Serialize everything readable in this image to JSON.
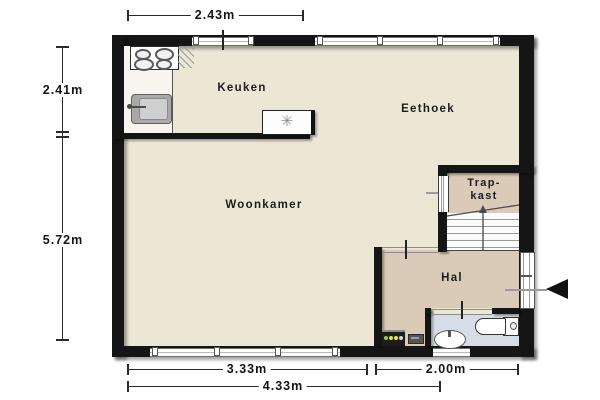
{
  "plan": {
    "rooms": {
      "keuken": "Keuken",
      "eethoek": "Eethoek",
      "woonkamer": "Woonkamer",
      "trapkast_line1": "Trap-",
      "trapkast_line2": "kast",
      "hal": "Hal"
    },
    "dimensions": {
      "top_width": "2.43m",
      "left_upper": "2.41m",
      "left_lower": "5.72m",
      "bottom_left": "3.33m",
      "bottom_right": "2.00m",
      "bottom_total": "4.33m"
    },
    "symbols": {
      "ventilation": "✳"
    },
    "colors": {
      "wall": "#151515",
      "floor_main": "#ece6d5",
      "floor_hall": "#d9cbb7",
      "floor_bath": "#d6dde7"
    }
  }
}
